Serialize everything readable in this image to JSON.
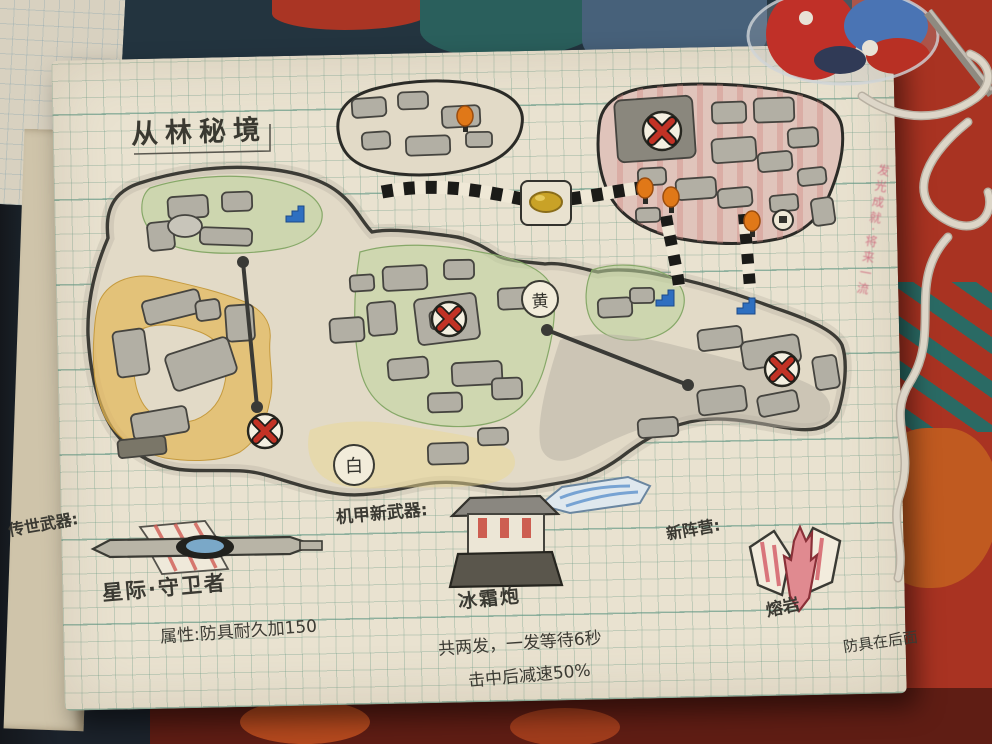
{
  "page": {
    "title": "从林秘境",
    "markers": {
      "yellow_point": "黄",
      "white_point": "白"
    },
    "legacy_weapon": {
      "heading": "传世武器:",
      "name": "星际·守卫者",
      "attribute": "属性:防具耐久加150"
    },
    "mech_weapon": {
      "heading": "机甲新武器:",
      "name": "冰霜炮",
      "stat_line1": "共两发，一发等待6秒",
      "stat_line2": "击中后减速50%"
    },
    "faction": {
      "heading": "新阵营:",
      "name": "熔岩",
      "note": "防具在后面"
    },
    "marginalia_red": "发光成就·将来一流",
    "icons": {
      "red_x_marker": "boss/danger marker (red X in circle)",
      "stairs_marker": "blue stairs",
      "lamp_marker": "orange torch lamp",
      "gold_marker": "gold chest on road",
      "striped_road": "black-white striped road",
      "zipline": "zipline cable"
    },
    "colors": {
      "page_bg": "#e9e2d0",
      "grid_green": "#6e9682",
      "zone_yellow": "#e3b95c",
      "zone_green": "#bcd39a",
      "zone_pink": "#dfa8a0",
      "building_gray": "#b2afa4",
      "marker_red": "#c23225",
      "stairs_blue": "#2e6fc0",
      "lamp_orange": "#e07818",
      "fabric_teal": "#2a5f5c",
      "fabric_red": "#a93322"
    }
  }
}
